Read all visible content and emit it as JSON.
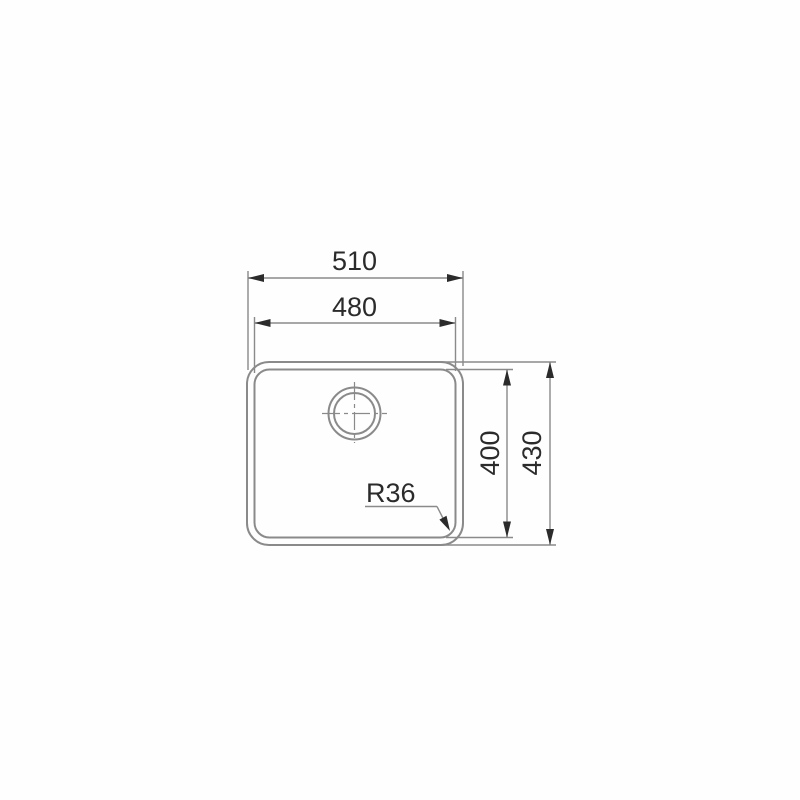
{
  "drawing": {
    "kind": "technical-dimension-drawing",
    "labels": {
      "dim_outer_width": "510",
      "dim_inner_width": "480",
      "dim_inner_height": "400",
      "dim_outer_height": "430",
      "corner_radius": "R36"
    },
    "colors": {
      "background": "#fefefe",
      "line": "#8a8a8a",
      "text": "#2b2b2b",
      "arrow": "#2b2b2b"
    }
  }
}
